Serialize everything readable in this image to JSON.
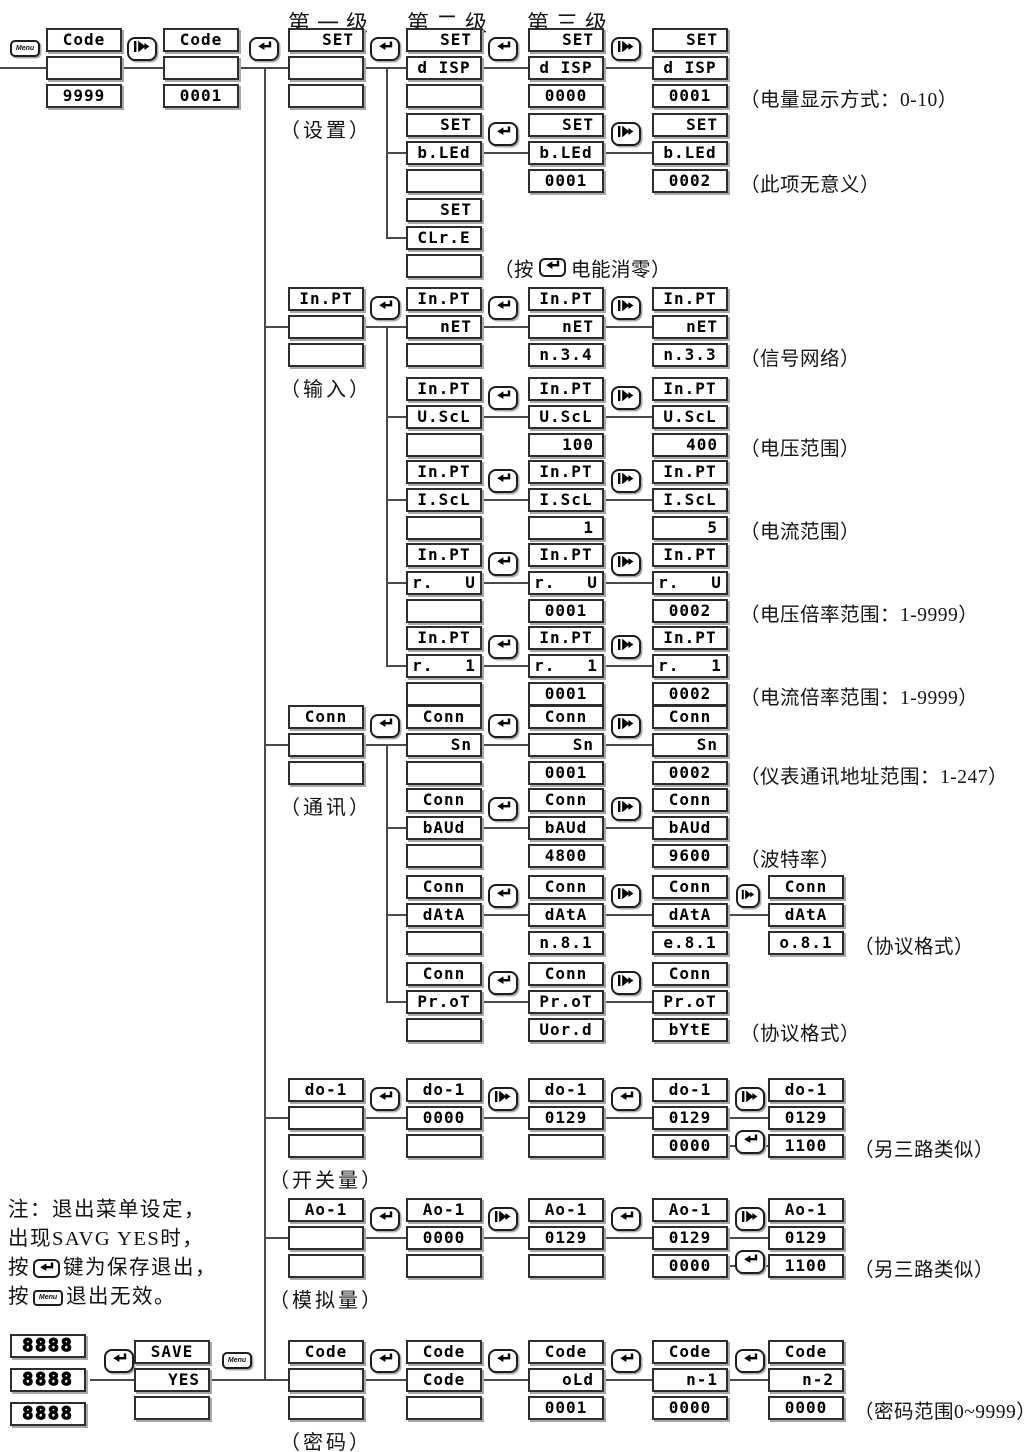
{
  "headers": [
    "第一级",
    "第二级",
    "第三级"
  ],
  "buttons": {
    "menu_label": "Menu"
  },
  "note": {
    "line1": "注：退出菜单设定，",
    "line2": "出现SAVG YES时，",
    "line3_pre": "按",
    "line3_post": "键为保存退出，",
    "line4_pre": "按",
    "line4_post": "退出无效。"
  },
  "colors": {
    "line": "#4a4a4a",
    "lcd_border": "#2e2e2e",
    "shadow": "#a8a8a8",
    "ink": "#111111"
  },
  "verticals": [
    {
      "x": 265,
      "y1": 67,
      "y2": 1381
    },
    {
      "x": 387,
      "y1": 67,
      "y2": 239
    },
    {
      "x": 387,
      "y1": 326,
      "y2": 667
    },
    {
      "x": 387,
      "y1": 744,
      "y2": 1003
    }
  ],
  "rows": [
    {
      "y": 28,
      "line": {
        "x1": 0,
        "x2": 662
      },
      "items": [
        {
          "t": "menu",
          "x": 10
        },
        {
          "t": "disp",
          "x": 46,
          "cells": [
            "Code",
            "",
            "9999"
          ]
        },
        {
          "t": "adv",
          "x": 127
        },
        {
          "t": "disp",
          "x": 163,
          "cells": [
            "Code",
            "",
            "0001"
          ]
        },
        {
          "t": "ent",
          "x": 249
        },
        {
          "t": "disp",
          "x": 288,
          "cells": [
            "SET",
            "",
            ""
          ],
          "label": "（设置）"
        },
        {
          "t": "ent",
          "x": 370
        },
        {
          "t": "disp",
          "x": 406,
          "cells": [
            "SET",
            "d ISP",
            ""
          ]
        },
        {
          "t": "ent",
          "x": 488
        },
        {
          "t": "disp",
          "x": 528,
          "cells": [
            "SET",
            "d ISP",
            "0000"
          ]
        },
        {
          "t": "adv",
          "x": 611
        },
        {
          "t": "disp",
          "x": 652,
          "cells": [
            "SET",
            "d ISP",
            "0001"
          ]
        },
        {
          "t": "ann",
          "x": 740,
          "text": "（电量显示方式：0-10）"
        }
      ]
    },
    {
      "y": 113,
      "line": {
        "x1": 387,
        "x2": 662
      },
      "items": [
        {
          "t": "disp",
          "x": 406,
          "cells": [
            "SET",
            "b.LEd",
            ""
          ]
        },
        {
          "t": "ent",
          "x": 488
        },
        {
          "t": "disp",
          "x": 528,
          "cells": [
            "SET",
            "b.LEd",
            "0001"
          ]
        },
        {
          "t": "adv",
          "x": 611
        },
        {
          "t": "disp",
          "x": 652,
          "cells": [
            "SET",
            "b.LEd",
            "0002"
          ]
        },
        {
          "t": "ann",
          "x": 740,
          "text": "（此项无意义）"
        }
      ]
    },
    {
      "y": 198,
      "line": {
        "x1": 387,
        "x2": 416
      },
      "items": [
        {
          "t": "disp",
          "x": 406,
          "cells": [
            "SET",
            "CLr.E",
            ""
          ]
        },
        {
          "t": "ann",
          "x": 494,
          "segments": [
            {
              "text": "（按"
            },
            {
              "icon": "enter"
            },
            {
              "text": "电能消零）"
            }
          ]
        }
      ]
    },
    {
      "y": 287,
      "line": {
        "x1": 265,
        "x2": 662
      },
      "items": [
        {
          "t": "disp",
          "x": 288,
          "cells": [
            "In.PT",
            "",
            ""
          ],
          "label": "（输入）"
        },
        {
          "t": "ent",
          "x": 370
        },
        {
          "t": "disp",
          "x": 406,
          "cells": [
            "In.PT",
            "nET",
            ""
          ]
        },
        {
          "t": "ent",
          "x": 488
        },
        {
          "t": "disp",
          "x": 528,
          "cells": [
            "In.PT",
            "nET",
            "n.3.4"
          ]
        },
        {
          "t": "adv",
          "x": 611
        },
        {
          "t": "disp",
          "x": 652,
          "cells": [
            "In.PT",
            "nET",
            "n.3.3"
          ]
        },
        {
          "t": "ann",
          "x": 740,
          "text": "（信号网络）"
        }
      ]
    },
    {
      "y": 377,
      "line": {
        "x1": 387,
        "x2": 662
      },
      "items": [
        {
          "t": "disp",
          "x": 406,
          "cells": [
            "In.PT",
            "U.ScL",
            ""
          ]
        },
        {
          "t": "ent",
          "x": 488
        },
        {
          "t": "disp",
          "x": 528,
          "cells": [
            "In.PT",
            "U.ScL",
            "100"
          ]
        },
        {
          "t": "adv",
          "x": 611
        },
        {
          "t": "disp",
          "x": 652,
          "cells": [
            "In.PT",
            "U.ScL",
            "400"
          ]
        },
        {
          "t": "ann",
          "x": 740,
          "text": "（电压范围）"
        }
      ]
    },
    {
      "y": 460,
      "line": {
        "x1": 387,
        "x2": 662
      },
      "items": [
        {
          "t": "disp",
          "x": 406,
          "cells": [
            "In.PT",
            "I.ScL",
            ""
          ]
        },
        {
          "t": "ent",
          "x": 488
        },
        {
          "t": "disp",
          "x": 528,
          "cells": [
            "In.PT",
            "I.ScL",
            "1"
          ]
        },
        {
          "t": "adv",
          "x": 611
        },
        {
          "t": "disp",
          "x": 652,
          "cells": [
            "In.PT",
            "I.ScL",
            "5"
          ]
        },
        {
          "t": "ann",
          "x": 740,
          "text": "（电流范围）"
        }
      ]
    },
    {
      "y": 543,
      "line": {
        "x1": 387,
        "x2": 662
      },
      "items": [
        {
          "t": "disp",
          "x": 406,
          "cells": [
            "In.PT",
            "r.   U",
            ""
          ]
        },
        {
          "t": "ent",
          "x": 488
        },
        {
          "t": "disp",
          "x": 528,
          "cells": [
            "In.PT",
            "r.   U",
            "0001"
          ]
        },
        {
          "t": "adv",
          "x": 611
        },
        {
          "t": "disp",
          "x": 652,
          "cells": [
            "In.PT",
            "r.   U",
            "0002"
          ]
        },
        {
          "t": "ann",
          "x": 740,
          "text": "（电压倍率范围：1-9999）"
        }
      ]
    },
    {
      "y": 626,
      "line": {
        "x1": 387,
        "x2": 662
      },
      "items": [
        {
          "t": "disp",
          "x": 406,
          "cells": [
            "In.PT",
            "r.   1",
            ""
          ]
        },
        {
          "t": "ent",
          "x": 488
        },
        {
          "t": "disp",
          "x": 528,
          "cells": [
            "In.PT",
            "r.   1",
            "0001"
          ]
        },
        {
          "t": "adv",
          "x": 611
        },
        {
          "t": "disp",
          "x": 652,
          "cells": [
            "In.PT",
            "r.   1",
            "0002"
          ]
        },
        {
          "t": "ann",
          "x": 740,
          "text": "（电流倍率范围：1-9999）"
        }
      ]
    },
    {
      "y": 705,
      "line": {
        "x1": 265,
        "x2": 662
      },
      "items": [
        {
          "t": "disp",
          "x": 288,
          "cells": [
            "Conn",
            "",
            ""
          ],
          "label": "（通讯）"
        },
        {
          "t": "ent",
          "x": 370
        },
        {
          "t": "disp",
          "x": 406,
          "cells": [
            "Conn",
            "Sn",
            ""
          ]
        },
        {
          "t": "ent",
          "x": 488
        },
        {
          "t": "disp",
          "x": 528,
          "cells": [
            "Conn",
            "Sn",
            "0001"
          ]
        },
        {
          "t": "adv",
          "x": 611
        },
        {
          "t": "disp",
          "x": 652,
          "cells": [
            "Conn",
            "Sn",
            "0002"
          ]
        },
        {
          "t": "ann",
          "x": 740,
          "text": "（仪表通讯地址范围：1-247）"
        }
      ]
    },
    {
      "y": 788,
      "line": {
        "x1": 387,
        "x2": 662
      },
      "items": [
        {
          "t": "disp",
          "x": 406,
          "cells": [
            "Conn",
            "bAUd",
            ""
          ]
        },
        {
          "t": "ent",
          "x": 488
        },
        {
          "t": "disp",
          "x": 528,
          "cells": [
            "Conn",
            "bAUd",
            "4800"
          ]
        },
        {
          "t": "adv",
          "x": 611
        },
        {
          "t": "disp",
          "x": 652,
          "cells": [
            "Conn",
            "bAUd",
            "9600"
          ]
        },
        {
          "t": "ann",
          "x": 740,
          "text": "（波特率）"
        }
      ]
    },
    {
      "y": 875,
      "line": {
        "x1": 387,
        "x2": 776
      },
      "items": [
        {
          "t": "disp",
          "x": 406,
          "cells": [
            "Conn",
            "dAtA",
            ""
          ]
        },
        {
          "t": "ent",
          "x": 488
        },
        {
          "t": "disp",
          "x": 528,
          "cells": [
            "Conn",
            "dAtA",
            "n.8.1"
          ]
        },
        {
          "t": "adv",
          "x": 611
        },
        {
          "t": "disp",
          "x": 652,
          "cells": [
            "Conn",
            "dAtA",
            "e.8.1"
          ]
        },
        {
          "t": "adv",
          "x": 736,
          "small": true
        },
        {
          "t": "disp",
          "x": 768,
          "cells": [
            "Conn",
            "dAtA",
            "o.8.1"
          ]
        },
        {
          "t": "ann",
          "x": 854,
          "text": "（协议格式）"
        }
      ]
    },
    {
      "y": 962,
      "line": {
        "x1": 387,
        "x2": 662
      },
      "items": [
        {
          "t": "disp",
          "x": 406,
          "cells": [
            "Conn",
            "Pr.oT",
            ""
          ]
        },
        {
          "t": "ent",
          "x": 488
        },
        {
          "t": "disp",
          "x": 528,
          "cells": [
            "Conn",
            "Pr.oT",
            "Uor.d"
          ]
        },
        {
          "t": "adv",
          "x": 611
        },
        {
          "t": "disp",
          "x": 652,
          "cells": [
            "Conn",
            "Pr.oT",
            "bYtE"
          ]
        },
        {
          "t": "ann",
          "x": 740,
          "text": "（协议格式）"
        }
      ]
    },
    {
      "y": 1078,
      "line": {
        "x1": 265,
        "x2": 778
      },
      "extra": [
        {
          "x1": 726,
          "x2": 772,
          "dy": 68
        }
      ],
      "items": [
        {
          "t": "disp",
          "x": 288,
          "cells": [
            "do-1",
            "",
            ""
          ],
          "label": "（开关量）"
        },
        {
          "t": "ent",
          "x": 370
        },
        {
          "t": "disp",
          "x": 406,
          "cells": [
            "do-1",
            "0000",
            ""
          ]
        },
        {
          "t": "adv",
          "x": 488
        },
        {
          "t": "disp",
          "x": 528,
          "cells": [
            "do-1",
            "0129",
            ""
          ]
        },
        {
          "t": "ent",
          "x": 611
        },
        {
          "t": "disp",
          "x": 652,
          "cells": [
            "do-1",
            "0129",
            "0000"
          ]
        },
        {
          "t": "adv",
          "x": 735
        },
        {
          "t": "ent",
          "x": 735,
          "dy": 52
        },
        {
          "t": "disp",
          "x": 768,
          "cells": [
            "do-1",
            "0129",
            "1100"
          ]
        },
        {
          "t": "ann",
          "x": 854,
          "text": "（另三路类似）"
        }
      ]
    },
    {
      "y": 1198,
      "line": {
        "x1": 265,
        "x2": 778
      },
      "extra": [
        {
          "x1": 726,
          "x2": 772,
          "dy": 68
        }
      ],
      "items": [
        {
          "t": "disp",
          "x": 288,
          "cells": [
            "Ao-1",
            "",
            ""
          ],
          "label": "（模拟量）"
        },
        {
          "t": "ent",
          "x": 370
        },
        {
          "t": "disp",
          "x": 406,
          "cells": [
            "Ao-1",
            "0000",
            ""
          ]
        },
        {
          "t": "adv",
          "x": 488
        },
        {
          "t": "disp",
          "x": 528,
          "cells": [
            "Ao-1",
            "0129",
            ""
          ]
        },
        {
          "t": "ent",
          "x": 611
        },
        {
          "t": "disp",
          "x": 652,
          "cells": [
            "Ao-1",
            "0129",
            "0000"
          ]
        },
        {
          "t": "adv",
          "x": 735
        },
        {
          "t": "ent",
          "x": 735,
          "dy": 52
        },
        {
          "t": "disp",
          "x": 768,
          "cells": [
            "Ao-1",
            "0129",
            "1100"
          ]
        },
        {
          "t": "ann",
          "x": 854,
          "text": "（另三路类似）"
        }
      ]
    },
    {
      "y": 1340,
      "line": {
        "x1": 90,
        "x2": 778
      },
      "items": [
        {
          "t": "disp",
          "x": 10,
          "cells": [
            "8888",
            "8888",
            "8888"
          ],
          "variant": "tall"
        },
        {
          "t": "ent",
          "x": 104
        },
        {
          "t": "disp",
          "x": 134,
          "cells": [
            "SAVE",
            "YES",
            ""
          ]
        },
        {
          "t": "menu",
          "x": 222
        },
        {
          "t": "disp",
          "x": 288,
          "cells": [
            "Code",
            "",
            ""
          ],
          "label": "（密码）"
        },
        {
          "t": "ent",
          "x": 370
        },
        {
          "t": "disp",
          "x": 406,
          "cells": [
            "Code",
            "Code",
            ""
          ]
        },
        {
          "t": "ent",
          "x": 488
        },
        {
          "t": "disp",
          "x": 528,
          "cells": [
            "Code",
            "oLd",
            "0001"
          ]
        },
        {
          "t": "ent",
          "x": 611
        },
        {
          "t": "disp",
          "x": 652,
          "cells": [
            "Code",
            "n-1",
            "0000"
          ]
        },
        {
          "t": "ent",
          "x": 735
        },
        {
          "t": "disp",
          "x": 768,
          "cells": [
            "Code",
            "n-2",
            "0000"
          ]
        },
        {
          "t": "ann",
          "x": 854,
          "text": "（密码范围0~9999）"
        }
      ]
    }
  ]
}
